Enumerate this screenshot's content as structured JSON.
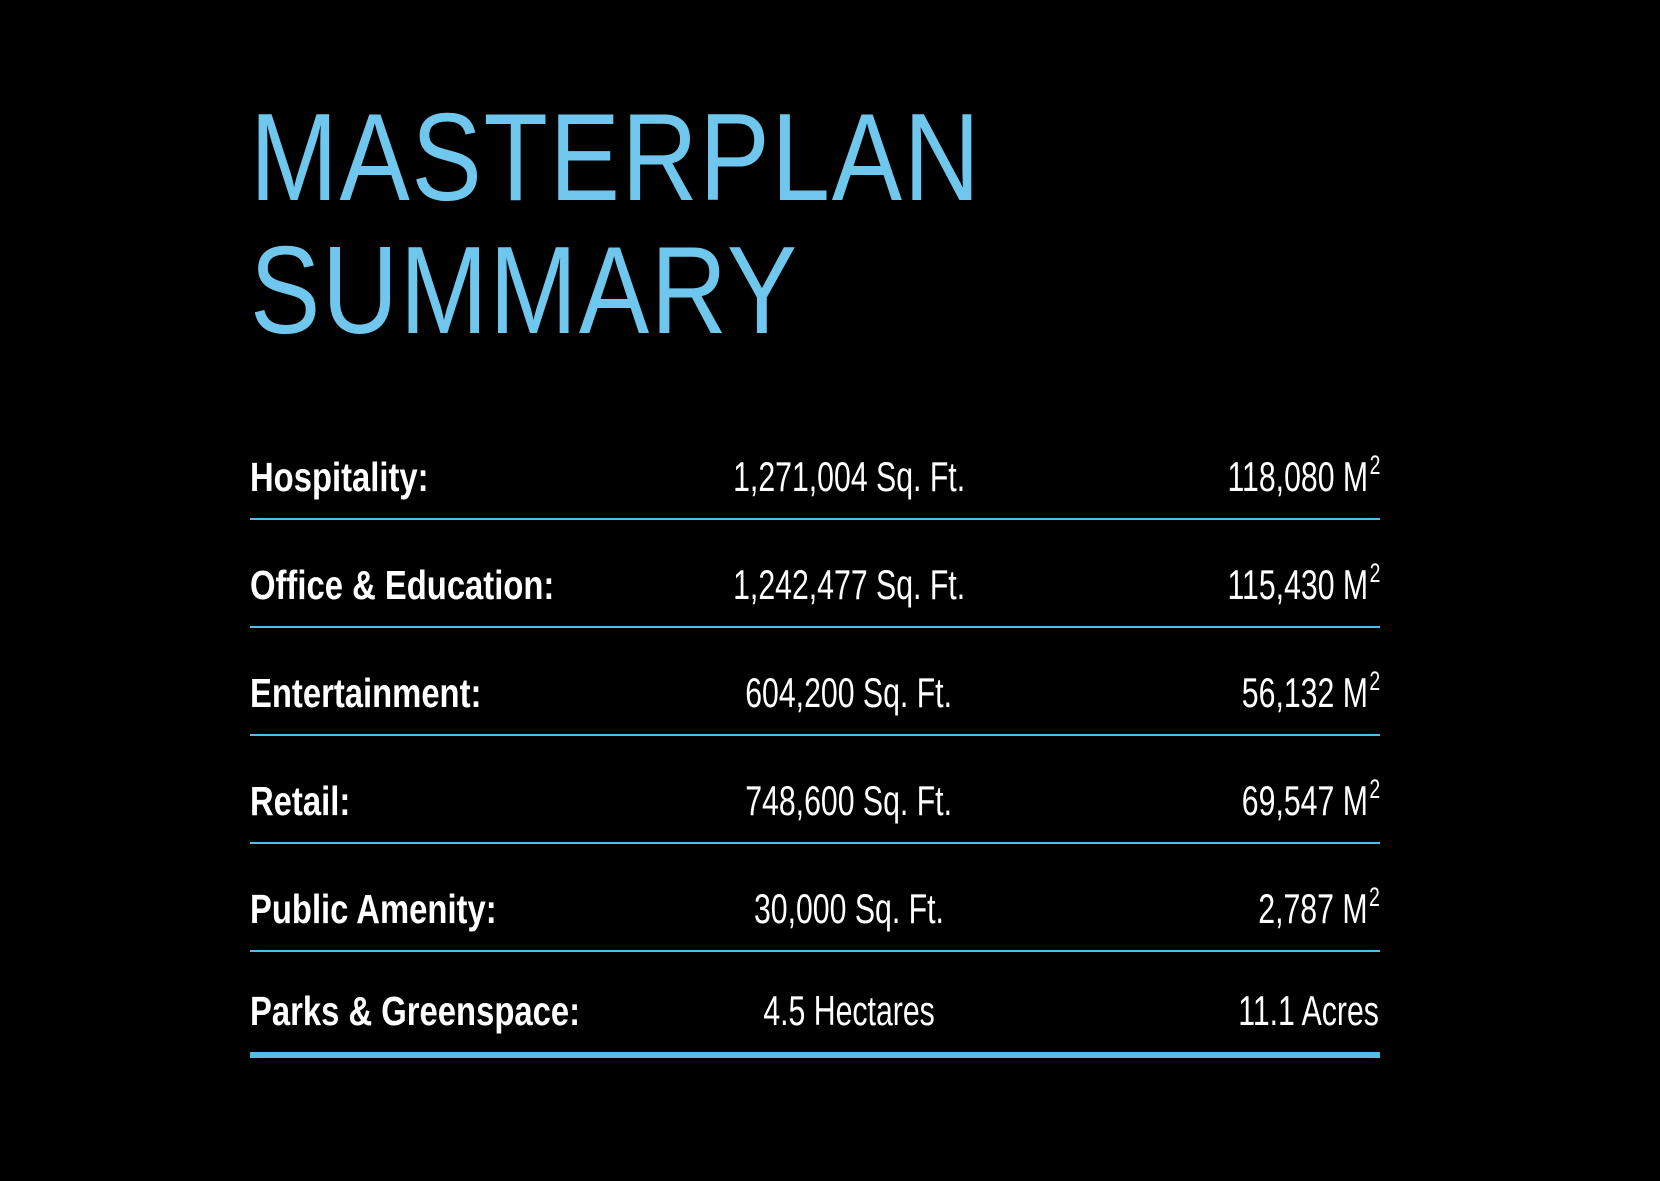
{
  "page": {
    "background_color": "#000000",
    "title_color": "#70C7EE",
    "divider_color": "#55BCE5",
    "text_color": "#FFFFFF"
  },
  "header": {
    "title_line1": "MASTERPLAN",
    "title_line2": "SUMMARY"
  },
  "summary_table": {
    "rows": [
      {
        "label": "Hospitality:",
        "imperial": "1,271,004 Sq. Ft.",
        "metric": "118,080 M",
        "metric_sup": "2"
      },
      {
        "label": "Office & Education:",
        "imperial": "1,242,477 Sq. Ft.",
        "metric": "115,430 M",
        "metric_sup": "2"
      },
      {
        "label": "Entertainment:",
        "imperial": "604,200 Sq. Ft.",
        "metric": "56,132 M",
        "metric_sup": "2"
      },
      {
        "label": "Retail:",
        "imperial": "748,600 Sq. Ft.",
        "metric": "69,547 M",
        "metric_sup": "2"
      },
      {
        "label": "Public Amenity:",
        "imperial": "30,000 Sq. Ft.",
        "metric": "2,787 M",
        "metric_sup": "2"
      },
      {
        "label": "Parks & Greenspace:",
        "imperial": "4.5 Hectares",
        "metric": "11.1 Acres"
      }
    ]
  }
}
